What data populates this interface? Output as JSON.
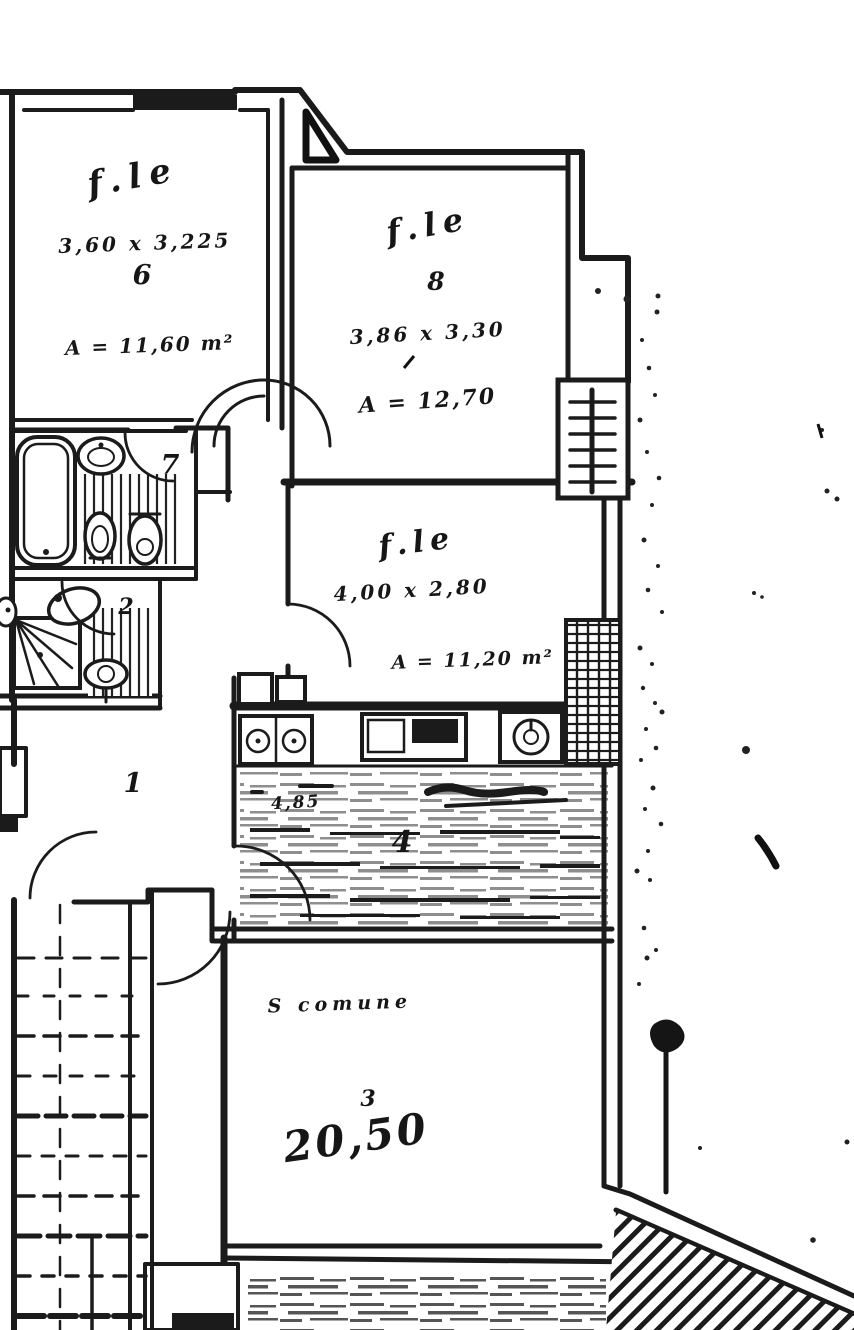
{
  "page": {
    "kind": "scanned cadastral floor plan",
    "paper_color": "#ffffff",
    "ink_color": "#1b1b1b"
  },
  "rooms": {
    "room_top_left": {
      "script": "f.le",
      "dims": "3,60 x 3,225",
      "number": "6",
      "area": "A = 11,60 m²"
    },
    "room_top_right": {
      "script": "f.le",
      "number": "8",
      "dims": "3,86 x 3,30",
      "area": "A = 12,70"
    },
    "room_middle": {
      "script": "f.le",
      "dims": "4,00 x 2,80",
      "area": "A = 11,20 m²"
    },
    "kitchen": {
      "number": "4",
      "dim": "4,85"
    },
    "living_room": {
      "label": "S comune",
      "number": "3",
      "area": "20,50"
    },
    "bathroom_main": {
      "number": "7"
    },
    "bathroom_small": {
      "number": "2"
    },
    "hallway": {
      "number": "1"
    }
  },
  "fixtures": [
    "bathtub",
    "washbasin",
    "bidet",
    "toilet",
    "shower",
    "kitchen-sink",
    "cooktop",
    "water-heater",
    "radiator",
    "window-grid"
  ]
}
